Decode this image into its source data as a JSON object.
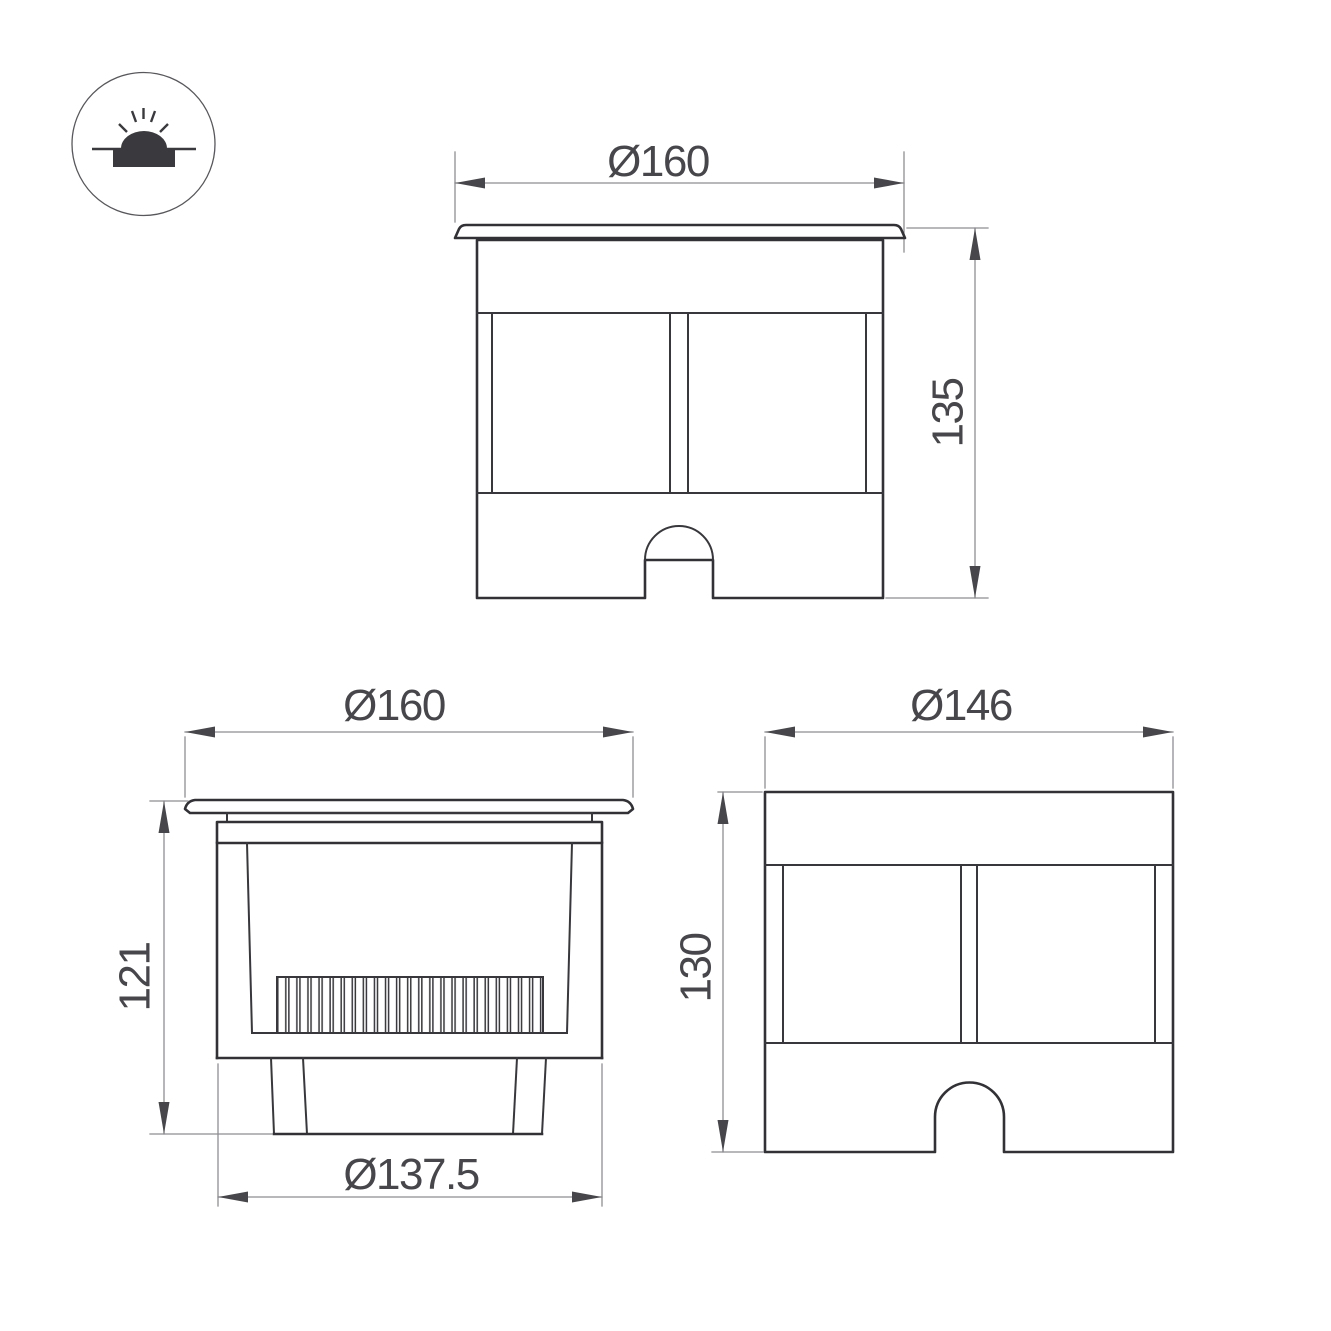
{
  "title": "recessed-ground-luminaire-dimension-drawing",
  "colors": {
    "background": "#ffffff",
    "outline": "#323236",
    "dimension_line": "#8e8e92",
    "annotation": "#47474b"
  },
  "icon": {
    "name": "recessed-ground-luminaire-symbol"
  },
  "views": {
    "front": {
      "diameter": "Ø160",
      "height": "135"
    },
    "side": {
      "diameter": "Ø160",
      "height": "121",
      "body_diameter": "Ø137.5"
    },
    "housing": {
      "diameter": "Ø146",
      "height": "130"
    }
  }
}
